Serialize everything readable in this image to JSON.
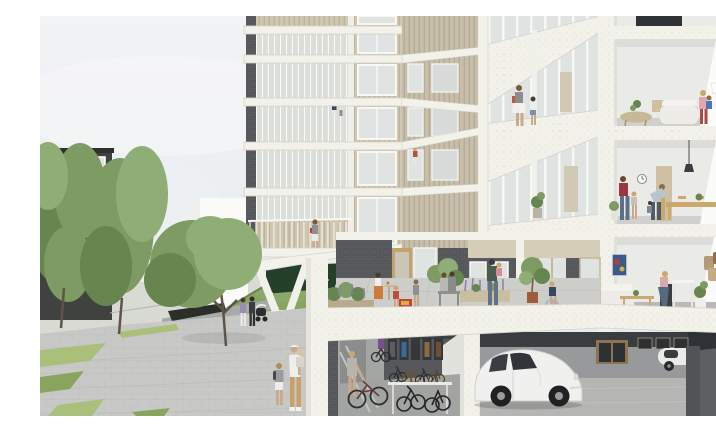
{
  "meta": {
    "type": "architectural-section-rendering",
    "description": "Cutaway perspective rendering of a residential tower: wood-and-glass balcony facade at left, sectioned open apartments at right, a podium courtyard terrace with residents, a bicycle storage room and an underground parking garage with a white car below, plaza with trees and pedestrians at street level."
  },
  "palette": {
    "sky_top": "#f1f3f5",
    "sky_bottom": "#e4e9ec",
    "slab_white": "#f2f1ea",
    "facade_wood": "#d0c7b2",
    "facade_wood_dark": "#bdb29a",
    "brick_dark": "#54565a",
    "brick_line": "#64666b",
    "glass": "#dfe3e2",
    "plaza": "#c8c9c6",
    "paving_light": "#cdcec9",
    "lawn": "#8aa45e",
    "lawn_light": "#a9bf7a",
    "hedge_dark": "#24402a",
    "tree_green": "#7d9b63",
    "tree_green_light": "#8fae75",
    "tree_green_dark": "#66854f",
    "interior_wall": "#eaeae7",
    "interior_wall_bright": "#fbfbf9",
    "interior_floor": "#d0d0cc",
    "carpet": "#b9bab8",
    "garage_wall": "#97999b",
    "garage_ceiling": "#3a3d40",
    "garage_floor": "#b5b6b3",
    "garage_dark": "#2e3135",
    "bike_wall": "#56585b",
    "car_white": "#f0f0ee",
    "wood_furniture": "#c9a96e",
    "wood_cabinet": "#cfc0a4",
    "door_wood": "#c2a36e",
    "accent_red": "#a8343c",
    "accent_orange": "#cd7a3a",
    "accent_purple": "#7b4f8f",
    "accent_pink": "#e4a7b0",
    "denim_blue": "#5d7089",
    "lavender": "#8a7fb5",
    "white_building": "#fafaf8",
    "dark_building": "#3f423f"
  },
  "scene": {
    "areas": [
      "sky",
      "neighboring-dark-apartment-building",
      "background-white-building",
      "street-trees",
      "lawn-with-path",
      "public-plaza",
      "residential-tower-facade",
      "balconies-with-glass-railings",
      "corner-terrace-galleries",
      "section-cut-apartments",
      "podium-courtyard-terrace",
      "bicycle-storage-room",
      "underground-parking-garage"
    ],
    "people": [
      "couple-with-stroller-on-plaza",
      "father-carrying-toddler-with-boy",
      "woman-and-child-on-gallery",
      "woman-on-first-floor-balcony",
      "residents-on-upper-balconies",
      "seated-woman-at-terrace-table",
      "toddler-with-toy-cart",
      "child-on-terrace",
      "couple-on-terrace-bench",
      "father-holding-toddler-on-terrace",
      "child-on-exercise-ball",
      "mother-with-child-by-wall-drawings",
      "family-playing-in-dining-room",
      "woman-sitting-in-living-room",
      "cyclist-in-bike-room",
      "woman-walking-bike"
    ],
    "objects": [
      "white-vw-beetle-car",
      "second-parked-car",
      "bicycle-racks",
      "wall-mounted-bicycles",
      "dining-table-with-chairs",
      "wall-clock",
      "pendant-lamp",
      "white-sofa",
      "round-wooden-table",
      "coffee-table",
      "wall-painting",
      "decorative-wall-art",
      "flat-screen-tv",
      "potted-plants",
      "planter-boxes-with-lavender",
      "v-shaped-columns",
      "entrance-canopy",
      "garage-back-door",
      "toy-play-cart"
    ]
  }
}
